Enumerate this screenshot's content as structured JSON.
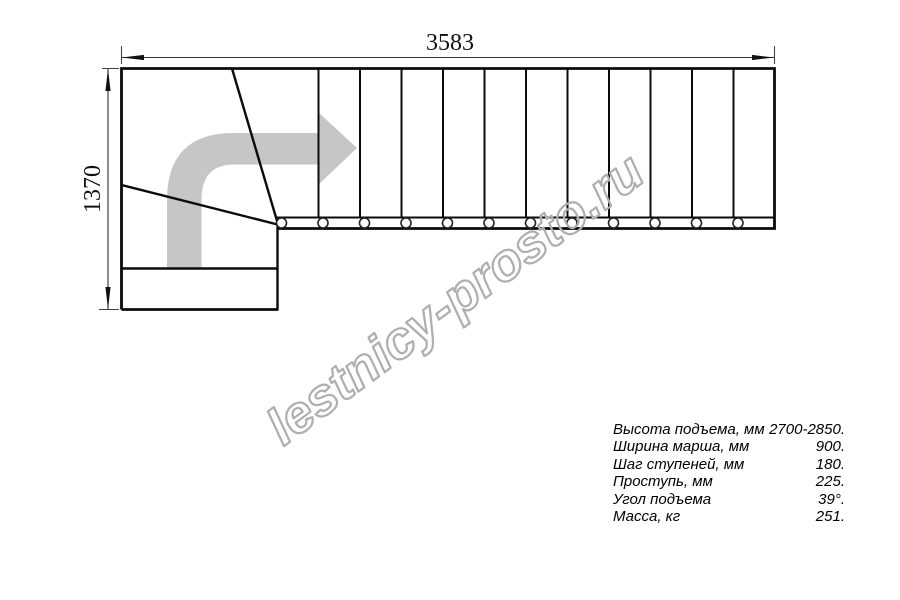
{
  "drawing": {
    "dim_width_label": "3583",
    "dim_height_label": "1370",
    "direction_arrow_icon": "direction-of-travel-arrow"
  },
  "watermark": {
    "text": "lestnicy-prosto.ru"
  },
  "specs": {
    "rows": [
      {
        "label": "Высота подъема, мм",
        "value": "2700-2850."
      },
      {
        "label": "Ширина марша, мм",
        "value": "900."
      },
      {
        "label": "Шаг ступеней, мм",
        "value": "180."
      },
      {
        "label": "Проступь, мм",
        "value": "225."
      },
      {
        "label": "Угол подъема",
        "value": "39°."
      },
      {
        "label": "Масса, кг",
        "value": "251."
      }
    ]
  },
  "colors": {
    "line": "#000000",
    "arrow_gray": "#c6c6c6",
    "watermark_gray": "#afafaf"
  }
}
